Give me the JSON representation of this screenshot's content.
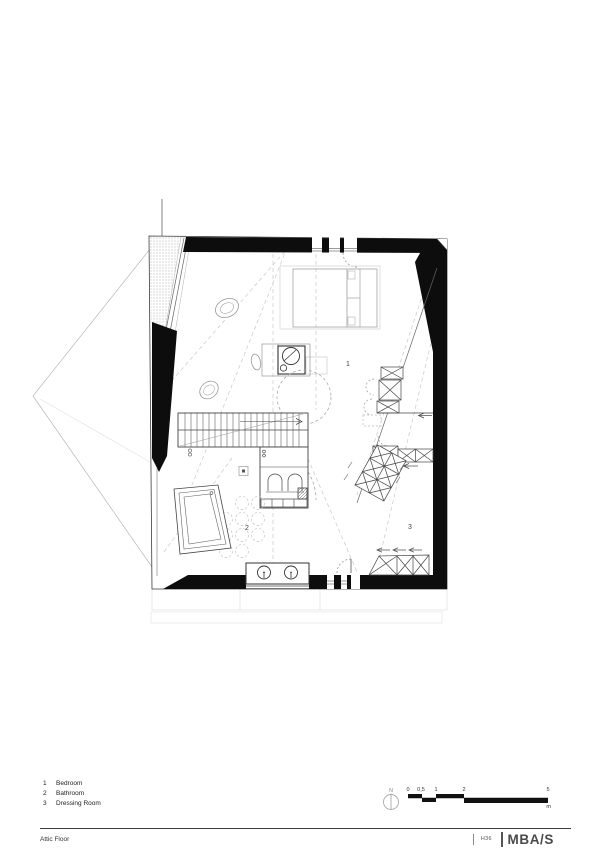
{
  "page": {
    "background": "#ffffff",
    "ink": "#1a1a1a",
    "wall_color": "#0d0d0d",
    "light_line": "#c9c9c9"
  },
  "rooms": [
    {
      "num": "1",
      "label": "Bedroom"
    },
    {
      "num": "2",
      "label": "Bathroom"
    },
    {
      "num": "3",
      "label": "Dressing Room"
    }
  ],
  "north": {
    "label": "N"
  },
  "scalebar": {
    "labels": [
      "0",
      "0,5",
      "1",
      "2",
      "5"
    ],
    "unit": "m"
  },
  "footer": {
    "drawing_title": "Attic Floor",
    "project_code": "H36",
    "brand": "MBA/S"
  }
}
